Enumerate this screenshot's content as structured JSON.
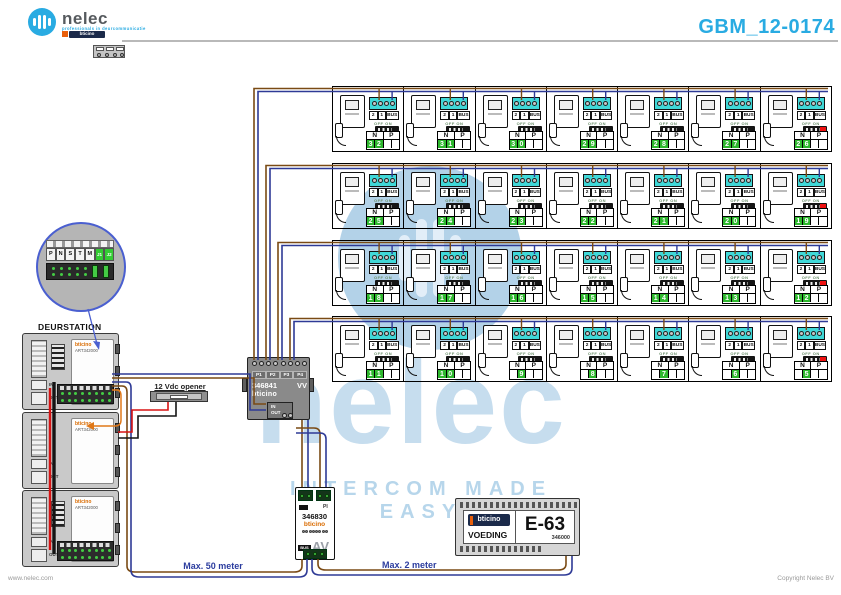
{
  "header": {
    "brand": "nelec",
    "tagline": "professionals in deurcommunicatie",
    "sub_brand": "bticino",
    "title": "GBM_12-0174"
  },
  "watermark": {
    "brand": "nelec",
    "slogan": "INTERCOM MADE EASY"
  },
  "grid": {
    "rows": 4,
    "cols": 7,
    "unit_numbers": [
      [
        32,
        31,
        30,
        29,
        28,
        27,
        26
      ],
      [
        25,
        24,
        23,
        22,
        21,
        20,
        19
      ],
      [
        18,
        17,
        16,
        15,
        14,
        13,
        12
      ],
      [
        11,
        10,
        9,
        8,
        7,
        6,
        5
      ]
    ],
    "terminal_labels": [
      "2",
      "1",
      "BUS"
    ],
    "np_labels": [
      "N",
      "P"
    ],
    "dip_label": "OFF ON"
  },
  "inset": {
    "terminal_labels": [
      "P",
      "N",
      "S",
      "T",
      "M",
      "J1",
      "J2"
    ]
  },
  "deurstation": {
    "title": "DEURSTATION",
    "brand": "bticino",
    "art": "ART342000",
    "in_label": "IN",
    "out_label": "OUT"
  },
  "opener": {
    "label": "12 Vdc opener"
  },
  "distributor": {
    "model": "346841",
    "suffix": "VV",
    "brand": "bticino",
    "ports": [
      "P1",
      "P2",
      "P3",
      "P4"
    ],
    "in_label": "IN",
    "out_label": "OUT"
  },
  "adapter": {
    "model": "346830",
    "pi_label": "PI",
    "brand": "bticino",
    "bus_label": "BUS",
    "av_label": "AV"
  },
  "psu": {
    "brand": "bticino",
    "model": "E-63",
    "label": "VOEDING",
    "code": "346000"
  },
  "notes": {
    "max50": "Max. 50 meter",
    "max2": "Max. 2 meter"
  },
  "footer": {
    "left": "www.nelec.com",
    "right": "Copyright Nelec BV"
  },
  "colors": {
    "accent": "#29abe2",
    "wire_blue": "#2e3a96",
    "wire_brown": "#7a4a14",
    "wire_red": "#d81313",
    "wire_black": "#141414",
    "wire_orange": "#e07818",
    "digit_green": "#2eb82e",
    "terminal_cyan": "#40d8d8",
    "watermark_blue": "#b3d2e8"
  }
}
